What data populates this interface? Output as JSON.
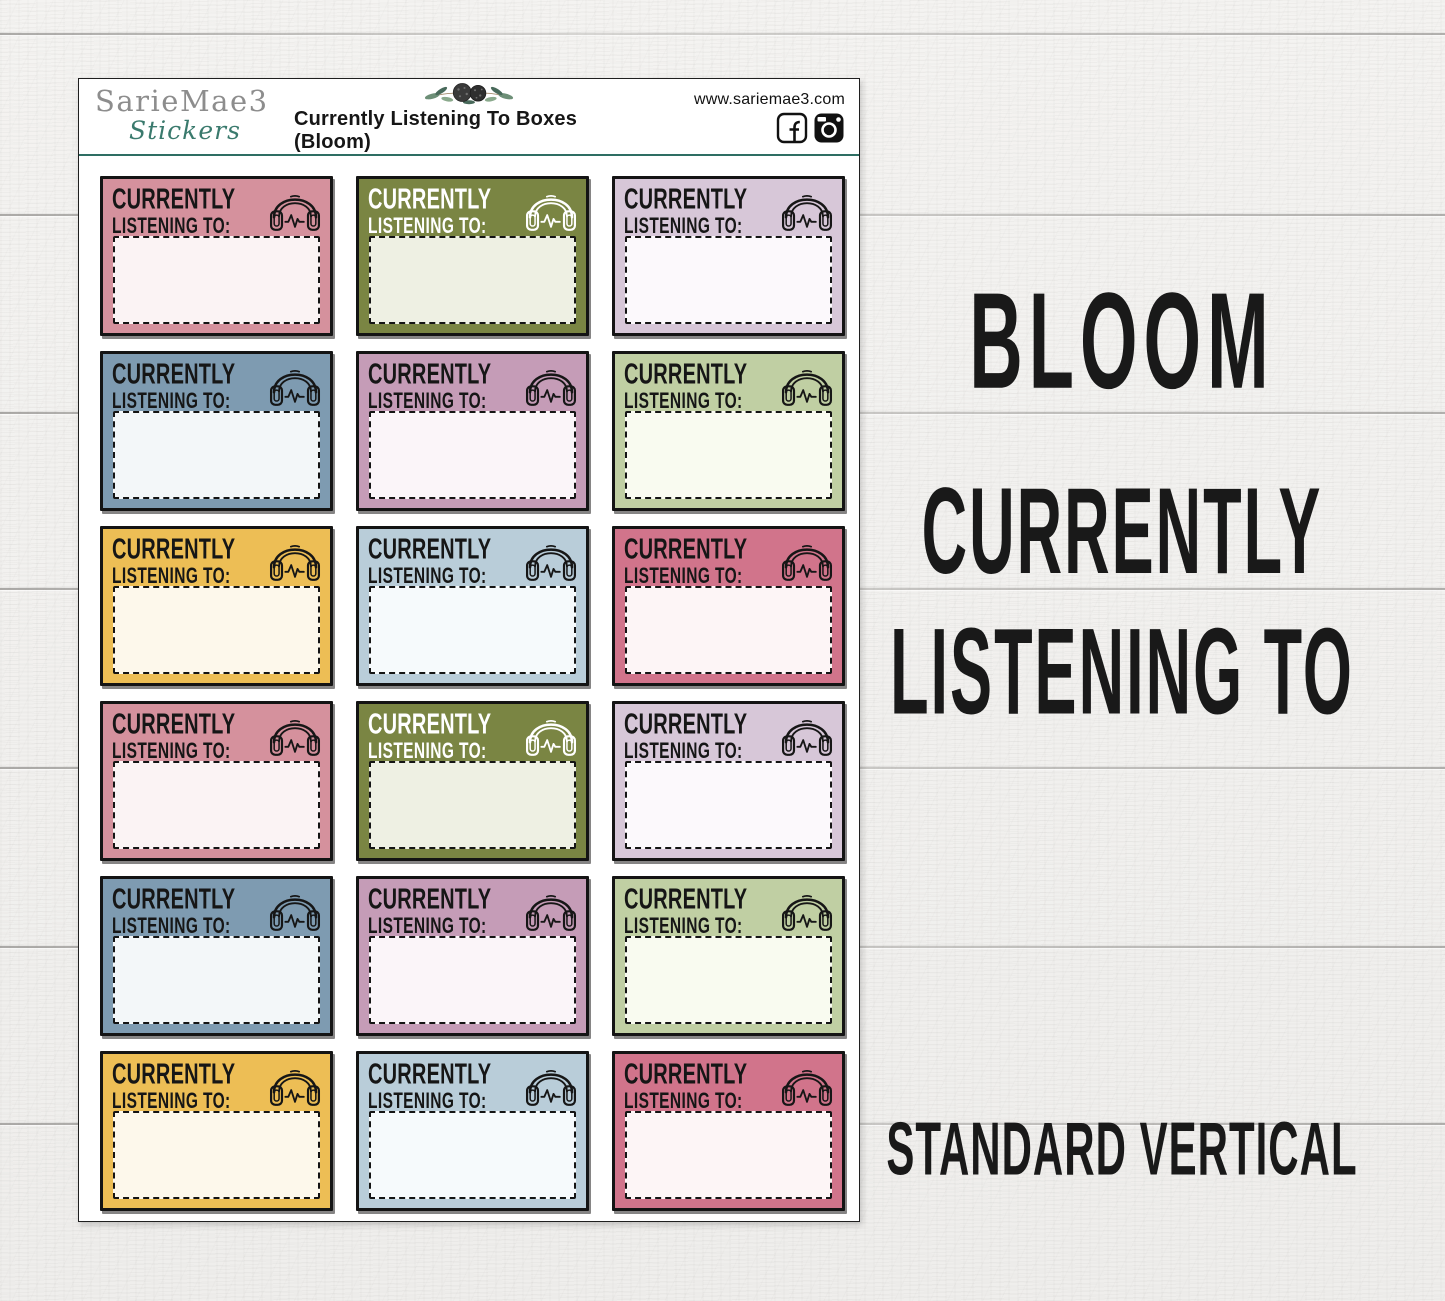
{
  "sheet": {
    "header": {
      "brand_name": "SarieMae3",
      "brand_sub": "Stickers",
      "title": "Currently Listening To Boxes (Bloom)",
      "website": "www.sariemae3.com",
      "divider_color": "#2e6e63",
      "social_icons": [
        "facebook-icon",
        "instagram-icon"
      ],
      "floral_icon": "floral-decoration"
    },
    "sticker": {
      "line1": "CURRENTLY",
      "line2": "LISTENING TO:",
      "icon": "headphones-icon"
    },
    "boxes": [
      {
        "color": "pink",
        "bg": "#d5919d",
        "fill": "#fbf3f4",
        "fg": "#161616"
      },
      {
        "color": "olive",
        "bg": "#7a8543",
        "fill": "#eef0e3",
        "fg": "#ffffff"
      },
      {
        "color": "lavender",
        "bg": "#d7c7d8",
        "fill": "#fcf9fc",
        "fg": "#161616"
      },
      {
        "color": "slate",
        "bg": "#7e9bb1",
        "fill": "#f3f7f9",
        "fg": "#161616"
      },
      {
        "color": "mauve",
        "bg": "#c59cb7",
        "fill": "#fbf5f9",
        "fg": "#161616"
      },
      {
        "color": "sage",
        "bg": "#c0cfa3",
        "fill": "#f9fbf0",
        "fg": "#161616"
      },
      {
        "color": "gold",
        "bg": "#edbe55",
        "fill": "#fdf8eb",
        "fg": "#161616"
      },
      {
        "color": "lightblue",
        "bg": "#b9cdd9",
        "fill": "#f6fafc",
        "fg": "#161616"
      },
      {
        "color": "rose",
        "bg": "#d1748b",
        "fill": "#fdf5f6",
        "fg": "#161616"
      },
      {
        "color": "pink",
        "bg": "#d5919d",
        "fill": "#fbf3f4",
        "fg": "#161616"
      },
      {
        "color": "olive",
        "bg": "#7a8543",
        "fill": "#eef0e3",
        "fg": "#ffffff"
      },
      {
        "color": "lavender",
        "bg": "#d7c7d8",
        "fill": "#fcf9fc",
        "fg": "#161616"
      },
      {
        "color": "slate",
        "bg": "#7e9bb1",
        "fill": "#f3f7f9",
        "fg": "#161616"
      },
      {
        "color": "mauve",
        "bg": "#c59cb7",
        "fill": "#fbf5f9",
        "fg": "#161616"
      },
      {
        "color": "sage",
        "bg": "#c0cfa3",
        "fill": "#f9fbf0",
        "fg": "#161616"
      },
      {
        "color": "gold",
        "bg": "#edbe55",
        "fill": "#fdf8eb",
        "fg": "#161616"
      },
      {
        "color": "lightblue",
        "bg": "#b9cdd9",
        "fill": "#f6fafc",
        "fg": "#161616"
      },
      {
        "color": "rose",
        "bg": "#d1748b",
        "fill": "#fdf5f6",
        "fg": "#161616"
      }
    ]
  },
  "right_panel": {
    "collection": "BLOOM",
    "product_line1": "CURRENTLY",
    "product_line2": "LISTENING TO",
    "variant": "STANDARD VERTICAL",
    "text_color": "#191919"
  }
}
